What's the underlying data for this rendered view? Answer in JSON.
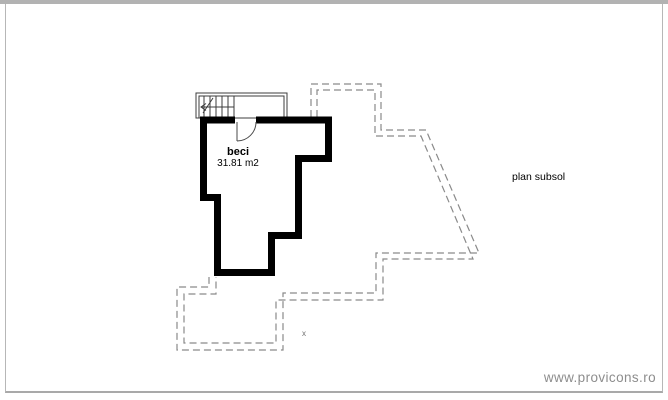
{
  "plan": {
    "title": "plan subsol",
    "room": {
      "name": "beci",
      "area": "31.81 m2"
    },
    "marker": "x",
    "colors": {
      "wall": "#000000",
      "outline": "#8a8a8a",
      "stair": "#3c3c3c",
      "door": "#4a4a4a"
    }
  },
  "frame": {
    "border_color": "#b2b2b2"
  },
  "footer": {
    "watermark": "www.provicons.ro"
  }
}
